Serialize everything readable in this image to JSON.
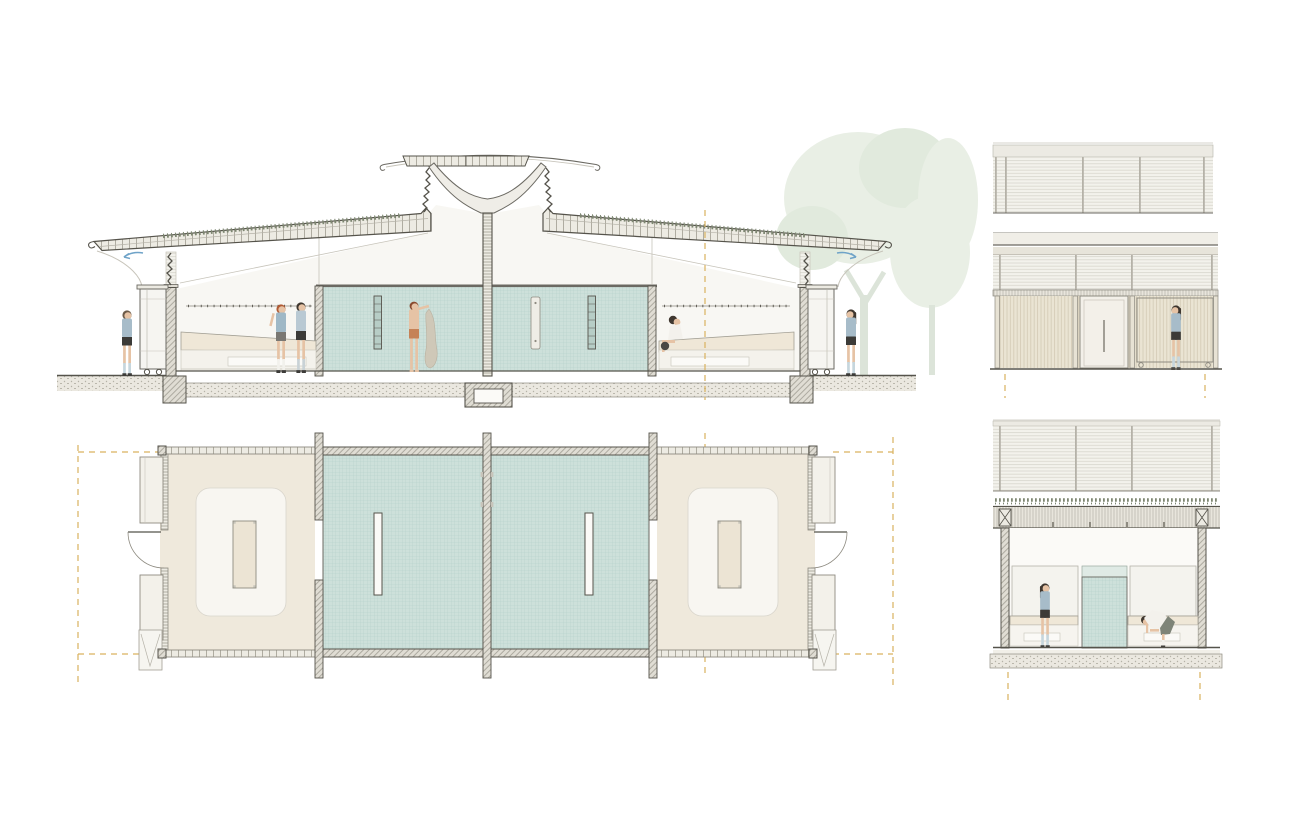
{
  "sheet": {
    "title": "Changing pavilion drawing sheet",
    "description": "Architectural presentation sheet with a longitudinal section, a floor plan, a front elevation and a cross section of a symmetrical changing / shower pavilion with butterfly green roofs and a central tree column."
  },
  "panels": [
    {
      "id": "section-long",
      "label": "Longitudinal section: two changing rooms with benches and lockers flanking central tiled shower rooms, winged green roofs, central branching column with apex canopy, rain chains, tree at right"
    },
    {
      "id": "floor-plan",
      "label": "Floor plan: two cream changing rooms with island and perimeter benches flanking two teal tiled shower rooms with privacy baffles; doors and lockers at each end; dashed canopy outline"
    },
    {
      "id": "elevation-front",
      "label": "Front elevation: two bands of horizontal clerestory louvres above a timber-slat wall with central door and sliding slat screen; standing figure"
    },
    {
      "id": "section-cross",
      "label": "Cross section: clerestory louvres over green roof beam, benches and wall panels either side of a central tiled shower wall, two figures"
    }
  ],
  "colors": {
    "paper": "#ffffff",
    "inkDark": "#55534b",
    "inkMid": "#8e8b81",
    "inkLight": "#c7c4ba",
    "roofFill": "#edebe3",
    "tickLine": "#a8a59a",
    "greenRoof": "#7d8671",
    "hatchBg": "#e0ddd4",
    "hatchLine": "#a09d93",
    "interior": "#f8f7f3",
    "tile": "#cde0da",
    "tileLine": "#b3cfc8",
    "tilePale": "#dfeae5",
    "cream": "#efe7d7",
    "creamEdge": "#a29f94",
    "panelLight": "#f4f3ee",
    "lockerFill": "#f6f5f1",
    "groundBg": "#ebe8e0",
    "groundDot": "#b5b2a7",
    "slatBg": "#eae4d3",
    "slatLine": "#d2c9b4",
    "postFill": "#e7e2d4",
    "louverBg": "#f3f2ec",
    "louverLine": "#d8d6cd",
    "beamBg": "#e8e5dc",
    "beamLine": "#b5b2a8",
    "accent": "#d9b25f",
    "arrowBlue": "#6fa3c8",
    "skin": "#e6c3a5",
    "shirtBlue": "#a7bcc9",
    "shirtBlue2": "#b9c9d3",
    "darkCloth": "#3c3b38",
    "grayShorts": "#7a7873",
    "sockWhite": "#f2f1ec",
    "sockBlue": "#c6d6dd",
    "hairDark": "#3f372f",
    "hairRed": "#b05a33",
    "hairBrown": "#6b5a48",
    "towel": "#cfc8b8",
    "orangeShorts": "#c58257",
    "skirtOlive": "#7e8478",
    "treeFoliage": "#e9efe5",
    "treeFoliage2": "#e1eadd",
    "treeTrunk": "#dce4d9",
    "floorCream": "#efe9dc",
    "innerFloor": "#f8f6f1",
    "white": "#fbfaf7"
  },
  "inventory": {
    "changing_rooms": 2,
    "shower_rooms": 2,
    "shower_baffles": 2,
    "island_benches": 2,
    "wheeled_lockers_in_section": 2,
    "plan_locker_banks": 4,
    "plan_doors": 2,
    "rain_chains": 4,
    "figures_total": 9
  },
  "figures": [
    {
      "panel": "section-long",
      "pose": "standing",
      "x": 127,
      "outfit": "blue tee, dark shorts, pale blue socks"
    },
    {
      "panel": "section-long",
      "pose": "standing, arm raised to hook rail",
      "x": 281,
      "outfit": "blue tee, grey shorts, white socks, red hair"
    },
    {
      "panel": "section-long",
      "pose": "standing",
      "x": 301,
      "outfit": "pale blue tee, black shorts"
    },
    {
      "panel": "section-long",
      "pose": "standing, hanging towel",
      "x": 414,
      "outfit": "shirtless, orange shorts"
    },
    {
      "panel": "section-long",
      "pose": "seated on bench",
      "x": 676,
      "outfit": "white top"
    },
    {
      "panel": "section-long",
      "pose": "standing",
      "x": 851,
      "outfit": "blue tee, black shorts, knee socks"
    },
    {
      "panel": "elevation-front",
      "pose": "standing",
      "x": 1176,
      "outfit": "blue tee, black shorts, knee socks"
    },
    {
      "panel": "section-cross",
      "pose": "standing",
      "x": 1045,
      "outfit": "blue tee, black shorts, knee socks"
    },
    {
      "panel": "section-cross",
      "pose": "bending over bench",
      "x": 1155,
      "outfit": "white top, olive skirt"
    }
  ]
}
